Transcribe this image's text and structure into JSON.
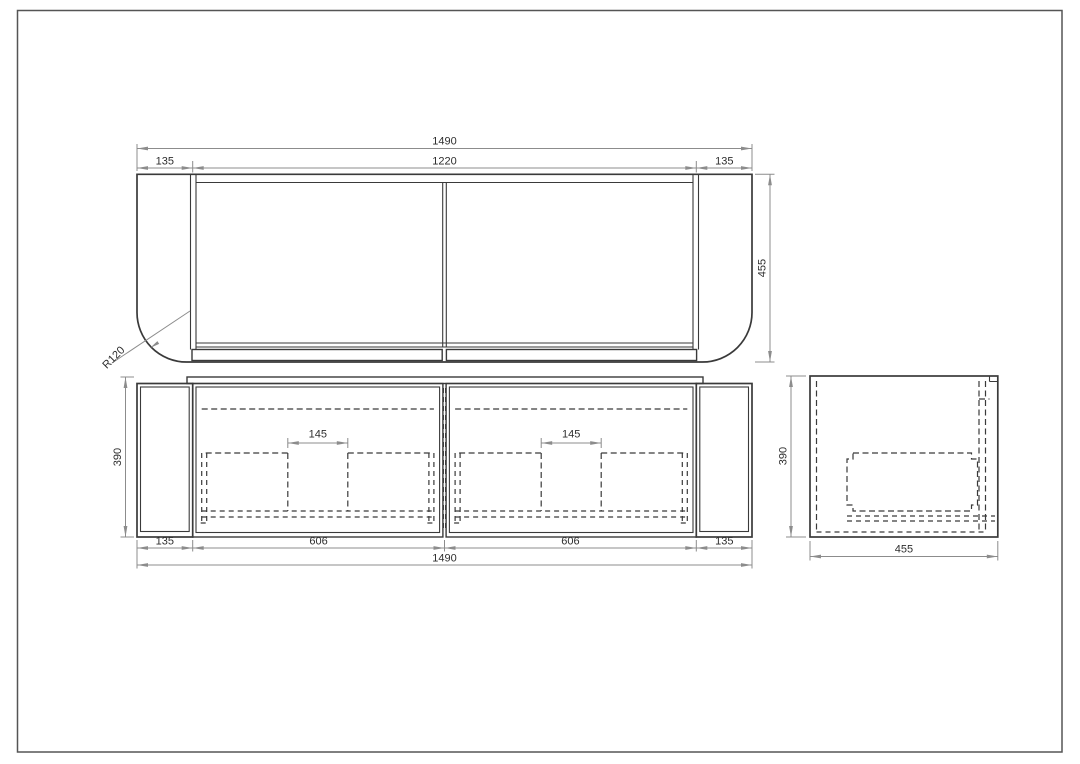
{
  "colors": {
    "line": "#3a3a3a",
    "dimension": "#8c8c8c",
    "text": "#2e2e2e",
    "background": "#ffffff",
    "border": "#555555"
  },
  "top_view": {
    "total_width": "1490",
    "inner_width": "1220",
    "left_side": "135",
    "right_side": "135",
    "depth": "455",
    "corner_radius": "R120"
  },
  "front_view": {
    "height": "390",
    "left_side": "135",
    "left_door": "606",
    "right_door": "606",
    "right_side": "135",
    "total_width": "1490",
    "left_cutout_gap": "145",
    "right_cutout_gap": "145"
  },
  "side_view": {
    "height": "390",
    "depth": "455"
  }
}
